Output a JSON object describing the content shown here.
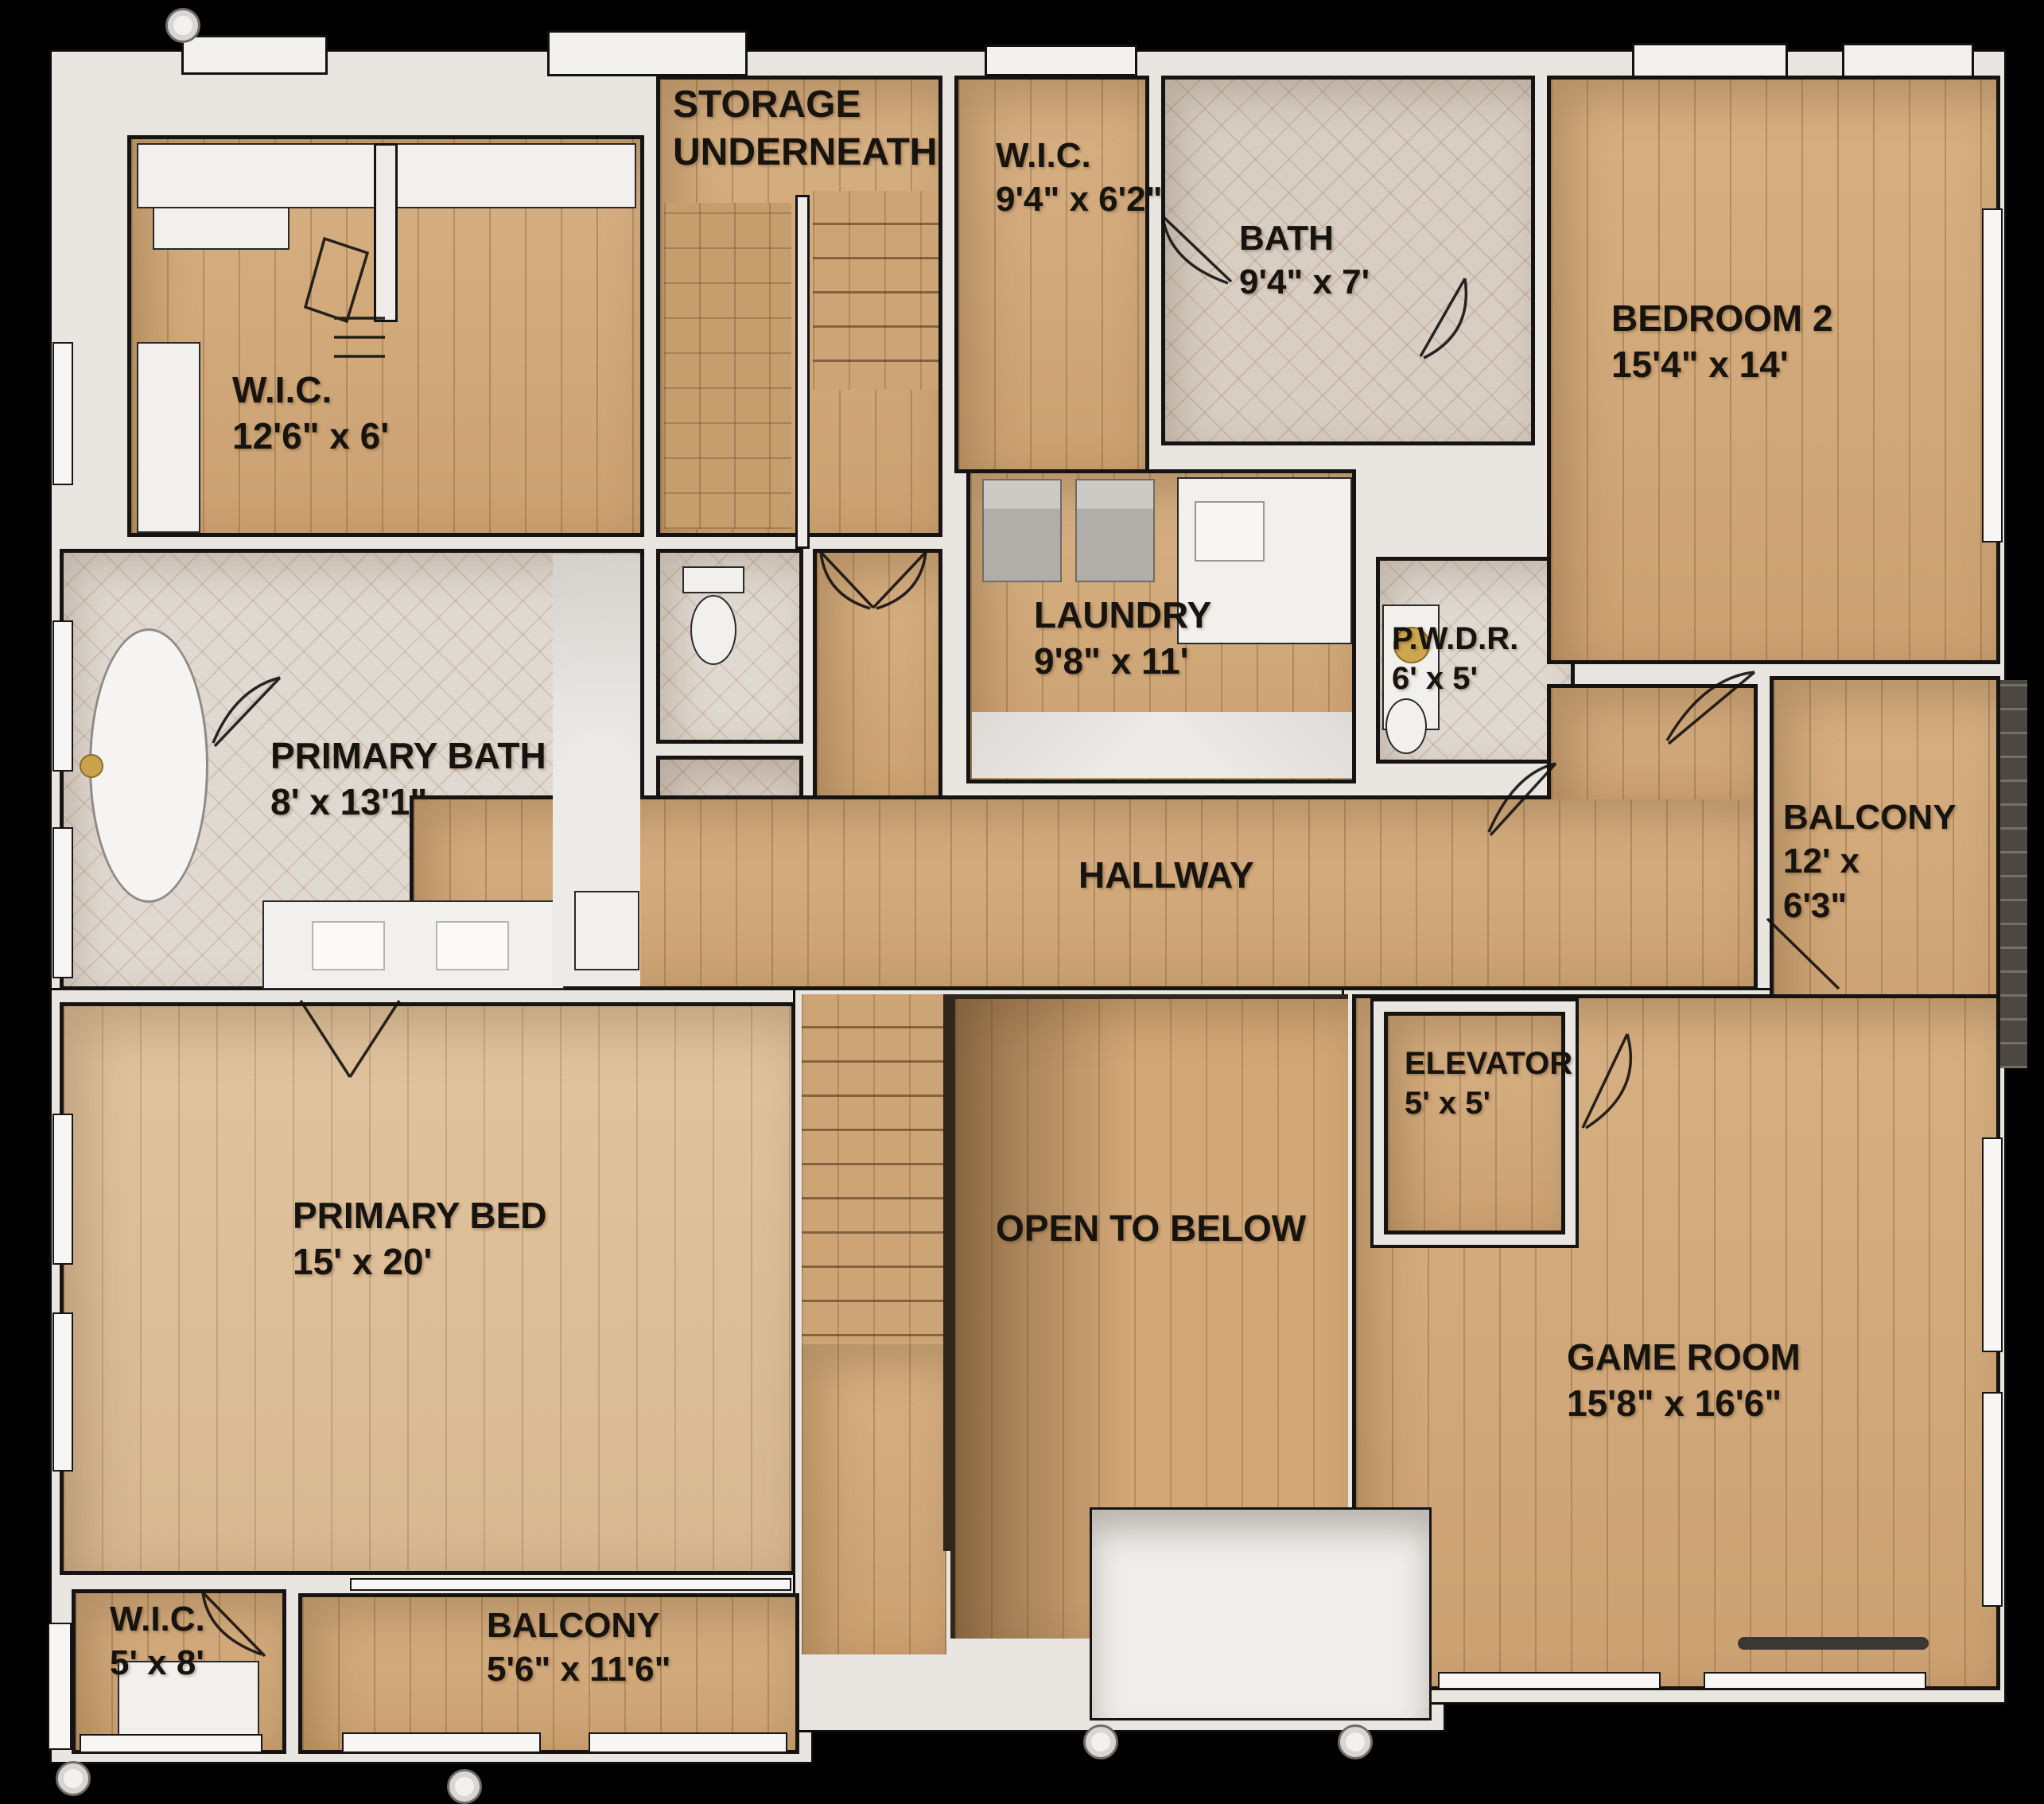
{
  "plan_type": "floor-plan",
  "rooms": {
    "wic_primary": {
      "label": "W.I.C.",
      "dims": "12'6\" x 6'"
    },
    "storage": {
      "label": "STORAGE",
      "label2": "UNDERNEATH"
    },
    "wic_hall": {
      "label": "W.I.C.",
      "dims": "9'4\" x 6'2\""
    },
    "bath": {
      "label": "BATH",
      "dims": "9'4\" x 7'"
    },
    "bedroom2": {
      "label": "BEDROOM 2",
      "dims": "15'4\" x 14'"
    },
    "laundry": {
      "label": "LAUNDRY",
      "dims": "9'8\" x 11'"
    },
    "powder": {
      "label": "P.W.D.R.",
      "dims": "6' x 5'"
    },
    "balcony_right": {
      "label": "BALCONY",
      "dims1": "12' x",
      "dims2": "6'3\""
    },
    "primary_bath": {
      "label": "PRIMARY BATH",
      "dims": "8' x 13'1\""
    },
    "hallway": {
      "label": "HALLWAY"
    },
    "elevator": {
      "label": "ELEVATOR",
      "dims": "5' x 5'"
    },
    "primary_bed": {
      "label": "PRIMARY BED",
      "dims": "15' x 20'"
    },
    "open_to_below": {
      "label": "OPEN TO BELOW"
    },
    "game_room": {
      "label": "GAME ROOM",
      "dims": "15'8\" x 16'6\""
    },
    "wic_primary_small": {
      "label": "W.I.C.",
      "dims": "5' x 8'"
    },
    "balcony_bottom": {
      "label": "BALCONY",
      "dims": "5'6\" x 11'6\""
    }
  },
  "colors": {
    "background": "#000000",
    "wall_fill": "#e9e5e0",
    "wall_line": "#161412",
    "wood_floor": "#d2a878",
    "wood_floor_light": "#ddbe97",
    "tile_floor": "#d8cec4",
    "marble": "#edebe8",
    "gold_fixture": "#c9a24a",
    "deck_dark": "#4c4741",
    "label_text": "#17140f"
  }
}
